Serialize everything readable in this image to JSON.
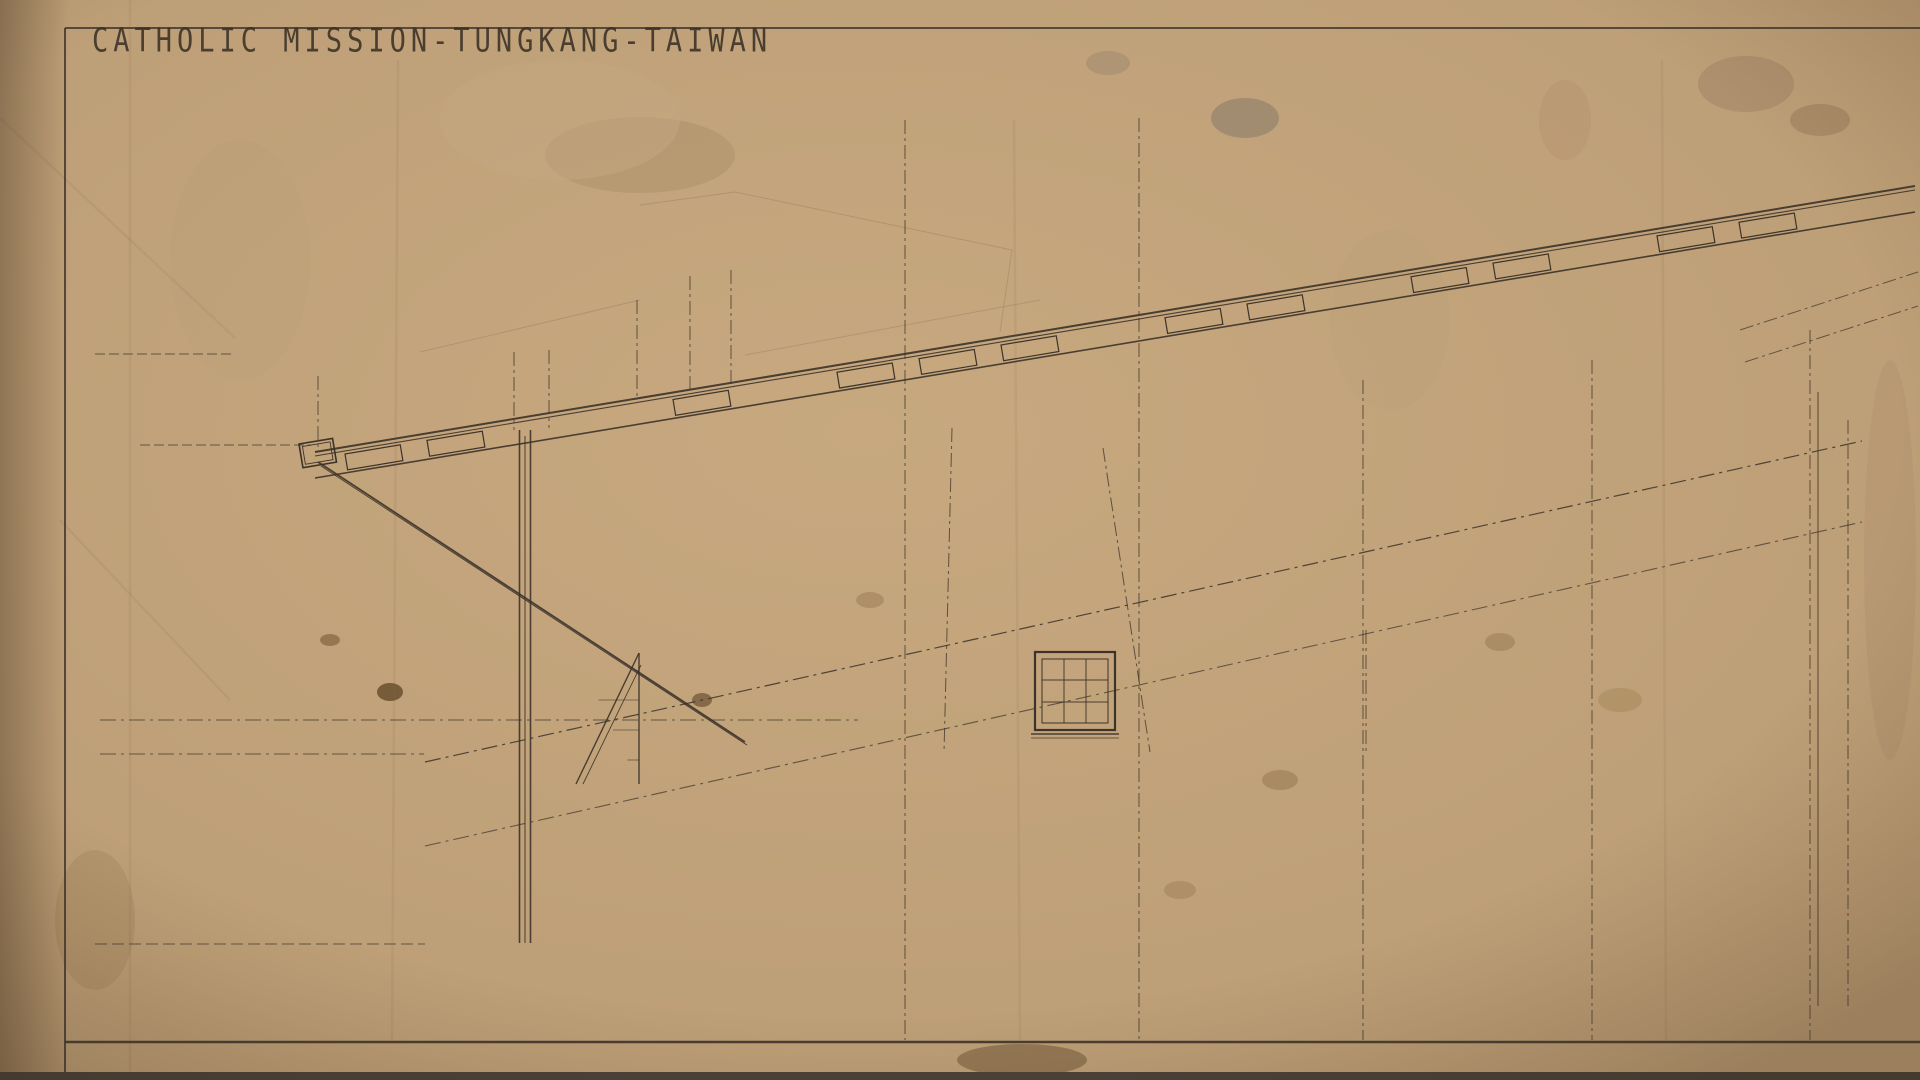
{
  "title": "CATHOLIC MISSION-TUNGKANG-TAIWAN",
  "colors": {
    "paper": "#c7a87f",
    "ink": "#3c332a",
    "red": "#bf3a22",
    "brown": "#8f4f28",
    "darkred": "#8e2d1c"
  },
  "top_columns": [
    [
      263,
      null,
      "",
      60,
      "二九八二〇"
    ],
    [
      427,
      null,
      "",
      76,
      "二六三二〇"
    ],
    [
      455,
      null,
      "",
      70,
      "二七〇〇〇"
    ],
    [
      519,
      null,
      "",
      80,
      "二五〇〇〇"
    ],
    [
      676,
      null,
      "",
      74,
      "二四一五〇"
    ],
    [
      713,
      null,
      "",
      70,
      "二三五〇〇"
    ],
    [
      905,
      40,
      "H",
      58,
      "二〇六五〇"
    ],
    [
      1139,
      37,
      "G",
      55,
      "一七一五〇"
    ],
    [
      1363,
      34,
      "F",
      52,
      "一三六五〇"
    ],
    [
      1592,
      31,
      "E",
      49,
      "一〇一五〇"
    ],
    [
      1810,
      29,
      "D",
      47,
      "六六五〇"
    ]
  ],
  "frame_letters": [
    [
      318,
      368,
      "L"
    ],
    [
      514,
      346,
      "K''"
    ],
    [
      549,
      341,
      "K'"
    ],
    [
      637,
      292,
      "K"
    ],
    [
      690,
      268,
      "J"
    ],
    [
      731,
      262,
      "I"
    ]
  ],
  "boxed_beam_labels": [
    [
      528,
      "G3"
    ],
    [
      623,
      "G1"
    ],
    [
      720,
      "G1'"
    ],
    [
      1085,
      "G1'"
    ],
    [
      1317,
      "G1'"
    ],
    [
      1550,
      "G1"
    ],
    [
      1787,
      "G1'"
    ]
  ],
  "purlin_label": "g1'",
  "gprime_labels": [
    [
      1194,
      288
    ],
    [
      1252,
      293
    ],
    [
      1310,
      270
    ],
    [
      1419,
      250
    ],
    [
      1477,
      255
    ],
    [
      1628,
      228
    ],
    [
      1686,
      233
    ],
    [
      1760,
      210
    ]
  ],
  "gprime_text": "g3'",
  "ann_black": [
    [
      472,
      402,
      "h8352"
    ],
    [
      487,
      419,
      "(322)",
      10
    ],
    [
      477,
      432,
      "h7960",
      10
    ],
    [
      527,
      397,
      "h8421"
    ],
    [
      590,
      386,
      "h8655",
      11
    ],
    [
      648,
      375,
      "h8806",
      11
    ],
    [
      693,
      368,
      "h8921",
      11
    ],
    [
      567,
      434,
      "h8066",
      10
    ],
    [
      593,
      421,
      "(366)",
      9
    ],
    [
      645,
      417,
      "h8200",
      10
    ],
    [
      698,
      404,
      "h8280",
      10
    ],
    [
      880,
      335,
      "h9427"
    ],
    [
      918,
      372,
      "h10061",
      10
    ],
    [
      1100,
      297,
      "h10048"
    ],
    [
      1158,
      333,
      "h9682",
      10
    ],
    [
      1335,
      257,
      "h10644"
    ],
    [
      1261,
      255,
      "h11040",
      11
    ],
    [
      1553,
      192,
      "h11560",
      11
    ],
    [
      1770,
      174,
      "h11611",
      11
    ],
    [
      1718,
      178,
      "h11011",
      10
    ],
    [
      195,
      350,
      "h7800",
      11
    ],
    [
      209,
      361,
      "(364)",
      9
    ],
    [
      200,
      371,
      "h7424",
      10
    ],
    [
      270,
      440,
      "h7800",
      11
    ],
    [
      290,
      456,
      "(360)",
      9
    ],
    [
      276,
      466,
      "h7434",
      10
    ],
    [
      405,
      416,
      "G3",
      16
    ],
    [
      438,
      417,
      "S1",
      14
    ],
    [
      865,
      476,
      "G1'",
      16
    ],
    [
      1331,
      396,
      "G1'",
      16
    ],
    [
      1470,
      353,
      "S1",
      13
    ],
    [
      1452,
      379,
      "g1'",
      12
    ],
    [
      1563,
      338,
      "G1",
      14
    ],
    [
      1597,
      234,
      "G1'",
      14
    ],
    [
      1105,
      441,
      "G1",
      13
    ],
    [
      803,
      673,
      "G3",
      15
    ],
    [
      1048,
      626,
      "G3",
      15
    ],
    [
      267,
      753,
      "G3",
      17
    ],
    [
      785,
      751,
      "G3",
      17
    ],
    [
      1010,
      746,
      "G3'",
      14
    ],
    [
      1233,
      739,
      "G3'",
      14
    ],
    [
      1702,
      739,
      "G3'",
      14
    ],
    [
      1868,
      736,
      "G3",
      12
    ],
    [
      920,
      640,
      "h4656",
      11
    ],
    [
      927,
      658,
      "(524)",
      9
    ],
    [
      921,
      673,
      "h4177",
      11
    ],
    [
      731,
      690,
      "3240",
      10
    ],
    [
      737,
      714,
      "(543)",
      9
    ],
    [
      645,
      716,
      "h3434",
      10
    ],
    [
      701,
      713,
      "(540)",
      9
    ],
    [
      700,
      703,
      "h3152",
      10
    ],
    [
      705,
      742,
      "h3104",
      10
    ],
    [
      640,
      747,
      "(501)",
      9
    ],
    [
      645,
      755,
      "h2863",
      10
    ],
    [
      1150,
      568,
      "h5706",
      11
    ],
    [
      1153,
      582,
      "(519)",
      9
    ],
    [
      1150,
      600,
      "h5187",
      11
    ],
    [
      1598,
      430,
      "h7042",
      11
    ],
    [
      1601,
      445,
      "(484)",
      9
    ],
    [
      1598,
      461,
      "h7458",
      11
    ],
    [
      1475,
      491,
      "S3",
      12
    ],
    [
      1595,
      491,
      "G2",
      12
    ],
    [
      1370,
      595,
      "G2",
      11
    ],
    [
      1572,
      501,
      "648",
      9
    ],
    [
      1578,
      531,
      "643",
      9
    ],
    [
      1350,
      612,
      "h5124",
      10
    ],
    [
      1360,
      636,
      "4758",
      9
    ],
    [
      1247,
      605,
      "g1",
      13
    ],
    [
      1138,
      703,
      "C1''",
      12
    ],
    [
      1162,
      705,
      "G1",
      12
    ],
    [
      1362,
      683,
      "C1'",
      14
    ],
    [
      1805,
      615,
      "C1",
      13
    ],
    [
      1838,
      601,
      "C4",
      13
    ],
    [
      1884,
      543,
      "W12",
      14
    ],
    [
      1898,
      341,
      "S3",
      12
    ],
    [
      1904,
      371,
      "G3''",
      11
    ],
    [
      1838,
      339,
      "h9207",
      10
    ],
    [
      1833,
      355,
      "(462)",
      9
    ],
    [
      1798,
      383,
      "h8745",
      10
    ],
    [
      1801,
      399,
      "5563",
      9
    ],
    [
      1803,
      417,
      "8197",
      9
    ],
    [
      1712,
      461,
      "G3''",
      11
    ],
    [
      1595,
      390,
      "h7481",
      10
    ],
    [
      422,
      772,
      "S2",
      12
    ],
    [
      478,
      813,
      "D1",
      14
    ],
    [
      558,
      803,
      "h2464",
      9
    ],
    [
      553,
      825,
      "(466)",
      8
    ],
    [
      554,
      842,
      "h2008",
      9
    ],
    [
      612,
      821,
      "G1",
      12
    ],
    [
      582,
      865,
      "G3",
      11
    ],
    [
      674,
      802,
      "g1",
      12
    ],
    [
      780,
      809,
      "C1",
      12
    ],
    [
      766,
      836,
      "h1672",
      9
    ],
    [
      766,
      865,
      "h1306",
      9
    ],
    [
      1125,
      748,
      "3020",
      9
    ],
    [
      1445,
      840,
      "900",
      10
    ],
    [
      1518,
      840,
      "900",
      10
    ],
    [
      1640,
      838,
      "900",
      10
    ],
    [
      1545,
      826,
      "W2",
      11
    ],
    [
      1709,
      832,
      "W2",
      11
    ],
    [
      1660,
      744,
      "190",
      8
    ],
    [
      1663,
      758,
      "320",
      8
    ],
    [
      1802,
      837,
      "C1",
      11
    ],
    [
      1824,
      841,
      "C1",
      11
    ],
    [
      1847,
      845,
      "D2",
      13
    ],
    [
      1843,
      983,
      "h-300",
      10
    ],
    [
      148,
      948,
      "G.L.",
      11
    ],
    [
      730,
      974,
      "(h090)",
      8
    ],
    [
      762,
      1001,
      "Y=215",
      8
    ],
    [
      790,
      1013,
      "F0-225",
      8
    ],
    [
      420,
      1002,
      "F0-215",
      8
    ],
    [
      245,
      1040,
      "Y0=2280",
      9
    ]
  ],
  "ann_red": [
    [
      610,
      361,
      "1010"
    ],
    [
      1073,
      284,
      "675"
    ],
    [
      1307,
      239,
      "750"
    ],
    [
      1688,
      154,
      "600"
    ],
    [
      1492,
      196,
      "695"
    ],
    [
      1038,
      633,
      "h4641"
    ],
    [
      1092,
      630,
      "h4611"
    ],
    [
      898,
      678,
      "(4600,4955)",
      9
    ],
    [
      1075,
      711,
      "h3511"
    ],
    [
      1058,
      737,
      "h3471"
    ],
    [
      1160,
      602,
      "h5180"
    ],
    [
      1186,
      610,
      "h5150"
    ],
    [
      1150,
      653,
      "(4048,6610)",
      9
    ],
    [
      1180,
      681,
      "h4050"
    ],
    [
      1188,
      703,
      "h4010"
    ],
    [
      1280,
      557,
      "h5720"
    ],
    [
      1300,
      570,
      "h5690"
    ],
    [
      1262,
      626,
      "(4097,6265)",
      9
    ],
    [
      1292,
      643,
      "h4550"
    ],
    [
      1303,
      665,
      "h4550"
    ],
    [
      1410,
      535,
      "h6288"
    ],
    [
      1426,
      546,
      "h6252"
    ],
    [
      1520,
      497,
      "h7045"
    ],
    [
      1536,
      510,
      "h7015"
    ],
    [
      1490,
      546,
      "(5107,5205)",
      9
    ],
    [
      1540,
      563,
      "h5875"
    ],
    [
      1652,
      374,
      "(5344,6950)",
      9
    ],
    [
      1686,
      405,
      "h5152"
    ],
    [
      1693,
      421,
      "h5112"
    ],
    [
      1618,
      465,
      "h7472"
    ],
    [
      1680,
      463,
      "h7450"
    ],
    [
      1615,
      521,
      "(9836,5023)",
      9
    ],
    [
      1638,
      538,
      "h6342"
    ],
    [
      1618,
      410,
      "(9226,6083)",
      9
    ],
    [
      1646,
      432,
      "h6302"
    ],
    [
      1745,
      417,
      "h8072"
    ],
    [
      1764,
      431,
      "h8049"
    ],
    [
      1712,
      488,
      "(8082,4684)",
      9
    ],
    [
      1757,
      498,
      "h6940"
    ],
    [
      1755,
      516,
      "h6800"
    ],
    [
      1872,
      349,
      "9240",
      10
    ],
    [
      1849,
      367,
      "9293",
      10
    ],
    [
      1833,
      389,
      "854",
      10
    ],
    [
      1522,
      757,
      "h2670"
    ],
    [
      1590,
      745,
      "h3220",
      10
    ],
    [
      1622,
      751,
      "h2970",
      10
    ],
    [
      1427,
      772,
      "450",
      10
    ],
    [
      1502,
      835,
      "1100",
      10
    ],
    [
      1557,
      849,
      "h2270",
      10
    ],
    [
      1586,
      842,
      "300",
      9
    ],
    [
      1532,
      881,
      "h1250",
      10
    ],
    [
      262,
      928,
      "h100",
      10
    ],
    [
      340,
      973,
      "350",
      8
    ],
    [
      343,
      989,
      "225",
      8
    ]
  ],
  "ann_brown": [
    [
      333,
      735,
      "h3310"
    ],
    [
      338,
      756,
      "h2950"
    ],
    [
      866,
      723,
      "h3420"
    ],
    [
      869,
      741,
      "h3290"
    ],
    [
      866,
      759,
      "h2970"
    ],
    [
      1082,
      973,
      "7150",
      10
    ]
  ],
  "verticals": [
    [
      903,
      460,
      "七三四〇",
      "k",
      13,
      false
    ],
    [
      683,
      497,
      "七九三〇",
      "k",
      12,
      false
    ],
    [
      1358,
      342,
      "九一〇",
      "k",
      12,
      false
    ],
    [
      1814,
      440,
      "五一五",
      "k",
      11,
      false
    ],
    [
      1859,
      248,
      "四八〇〇",
      "r",
      11,
      false
    ],
    [
      420,
      646,
      "二八二〇〇",
      "k",
      13,
      true
    ],
    [
      602,
      828,
      "一九三〇",
      "k",
      9,
      false
    ],
    [
      207,
      572,
      "七八〇〇公厘",
      "k",
      15,
      false
    ]
  ],
  "mm_note": "(MM)",
  "cjk_mixed": [
    [
      445,
      684,
      "地",
      "G1'"
    ],
    [
      436,
      708,
      "中央",
      "G2"
    ]
  ],
  "windows": [
    [
      1035,
      652
    ],
    [
      1145,
      617
    ],
    [
      1267,
      582
    ],
    [
      1384,
      547
    ],
    [
      1500,
      512
    ],
    [
      1616,
      477
    ],
    [
      1726,
      435
    ]
  ],
  "window_label": "W3",
  "cabinet": {
    "top_cells": [
      "900",
      "900",
      "900",
      "900",
      "900",
      "900"
    ],
    "sub_cell2": "W2",
    "sub_cell5": "450",
    "row_dims": [
      "360",
      "360",
      "360",
      "325",
      "325"
    ],
    "bottom_dim": "250",
    "mid_dims": [
      "900",
      "900",
      "900",
      "900",
      "900",
      "900"
    ],
    "mid_xs": [
      965,
      1037,
      1092,
      1137,
      1189,
      1270
    ],
    "d_label": "d",
    "g3_label": "G3",
    "door_label": "W2",
    "door_h": "1100",
    "below": "1020",
    "tick": "30",
    "gap": "100"
  },
  "dim": {
    "ticks": [
      310,
      516,
      603,
      659,
      702,
      890,
      1121,
      1352,
      1583,
      1814
    ],
    "labels": [
      [
        413,
        "3120"
      ],
      [
        574,
        "1320"
      ],
      [
        646,
        "850"
      ],
      [
        706,
        "650"
      ],
      [
        798,
        "2850"
      ],
      [
        1000,
        "3500"
      ],
      [
        1232,
        "3500"
      ],
      [
        1462,
        "3800"
      ],
      [
        1692,
        "3500"
      ],
      [
        1905,
        "350"
      ]
    ],
    "small": [
      526,
      1047,
      "1010"
    ]
  },
  "foundation": {
    "fg1_label": "FG1",
    "fg1": [
      [
        612,
        966
      ],
      [
        828,
        970
      ],
      [
        1052,
        982
      ],
      [
        1208,
        984
      ],
      [
        1455,
        989
      ],
      [
        1686,
        984
      ]
    ],
    "f1_label": "F1",
    "f1": [
      [
        655,
        1016
      ],
      [
        903,
        1014
      ],
      [
        1093,
        1016
      ],
      [
        1355,
        1017
      ],
      [
        1578,
        1016
      ],
      [
        1798,
        1016
      ]
    ],
    "f1_red_label": "f1",
    "f1_red": [
      [
        722,
        1019
      ],
      [
        1153,
        1018
      ],
      [
        1387,
        1020
      ],
      [
        1833,
        1019
      ]
    ],
    "red_cluster": [
      [
        1180,
        966,
        "11216A."
      ],
      [
        1192,
        980,
        "11316C."
      ],
      [
        1203,
        994,
        "11214C."
      ],
      [
        1230,
        1038,
        "11418.6."
      ]
    ],
    "lambda": [
      1148,
      1022,
      "ΛΛΚΛ"
    ]
  },
  "datum_symbol": "⊕"
}
